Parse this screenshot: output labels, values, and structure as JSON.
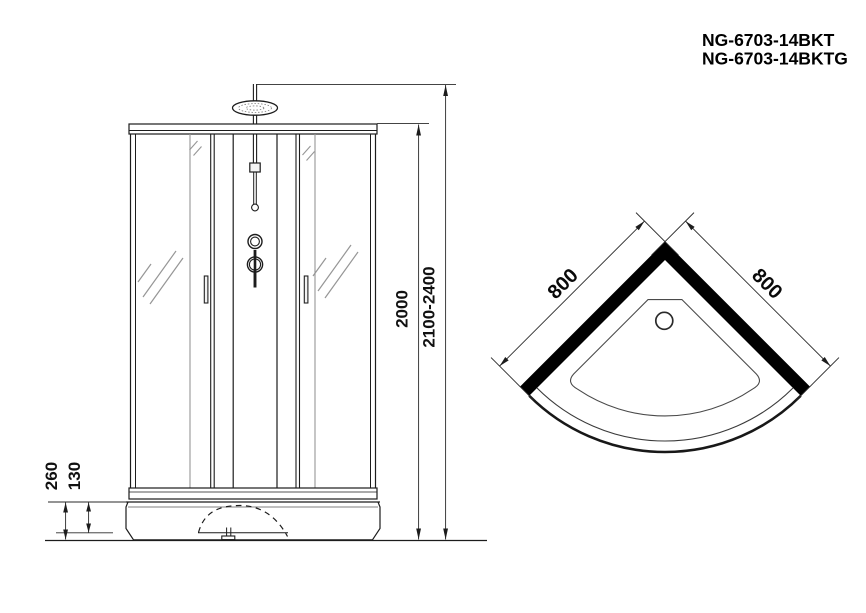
{
  "header": {
    "model_line_1": "NG-6703-14BKT",
    "model_line_2": "NG-6703-14BKTG"
  },
  "front_view": {
    "dim_cabin_height": "2000",
    "dim_total_height": "2100-2400",
    "dim_tray_height": "260",
    "dim_apron_height": "130"
  },
  "plan_view": {
    "dim_left_side": "800",
    "dim_right_side": "800"
  },
  "colors": {
    "background": "#ffffff",
    "line": "#1c1c1c",
    "gray_line": "#969696",
    "wall_fill": "#000000",
    "text": "#111111"
  }
}
